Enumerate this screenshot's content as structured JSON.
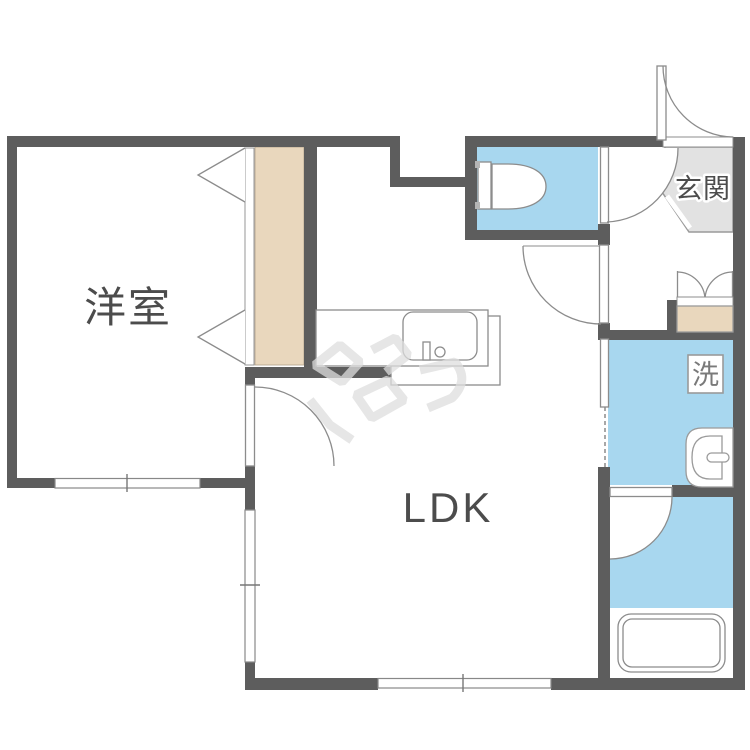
{
  "plan": {
    "labels": {
      "western_room": "洋室",
      "living": "LDK",
      "entrance": "玄関",
      "washer": "洗"
    },
    "colors": {
      "wall": "#5d5d5d",
      "water_area": "#a8d7ef",
      "storage": "#e9d7bd",
      "entrance_floor": "#e2e2e2",
      "fixture_line": "#8c8c8c",
      "label_text": "#4c4c4c"
    }
  }
}
